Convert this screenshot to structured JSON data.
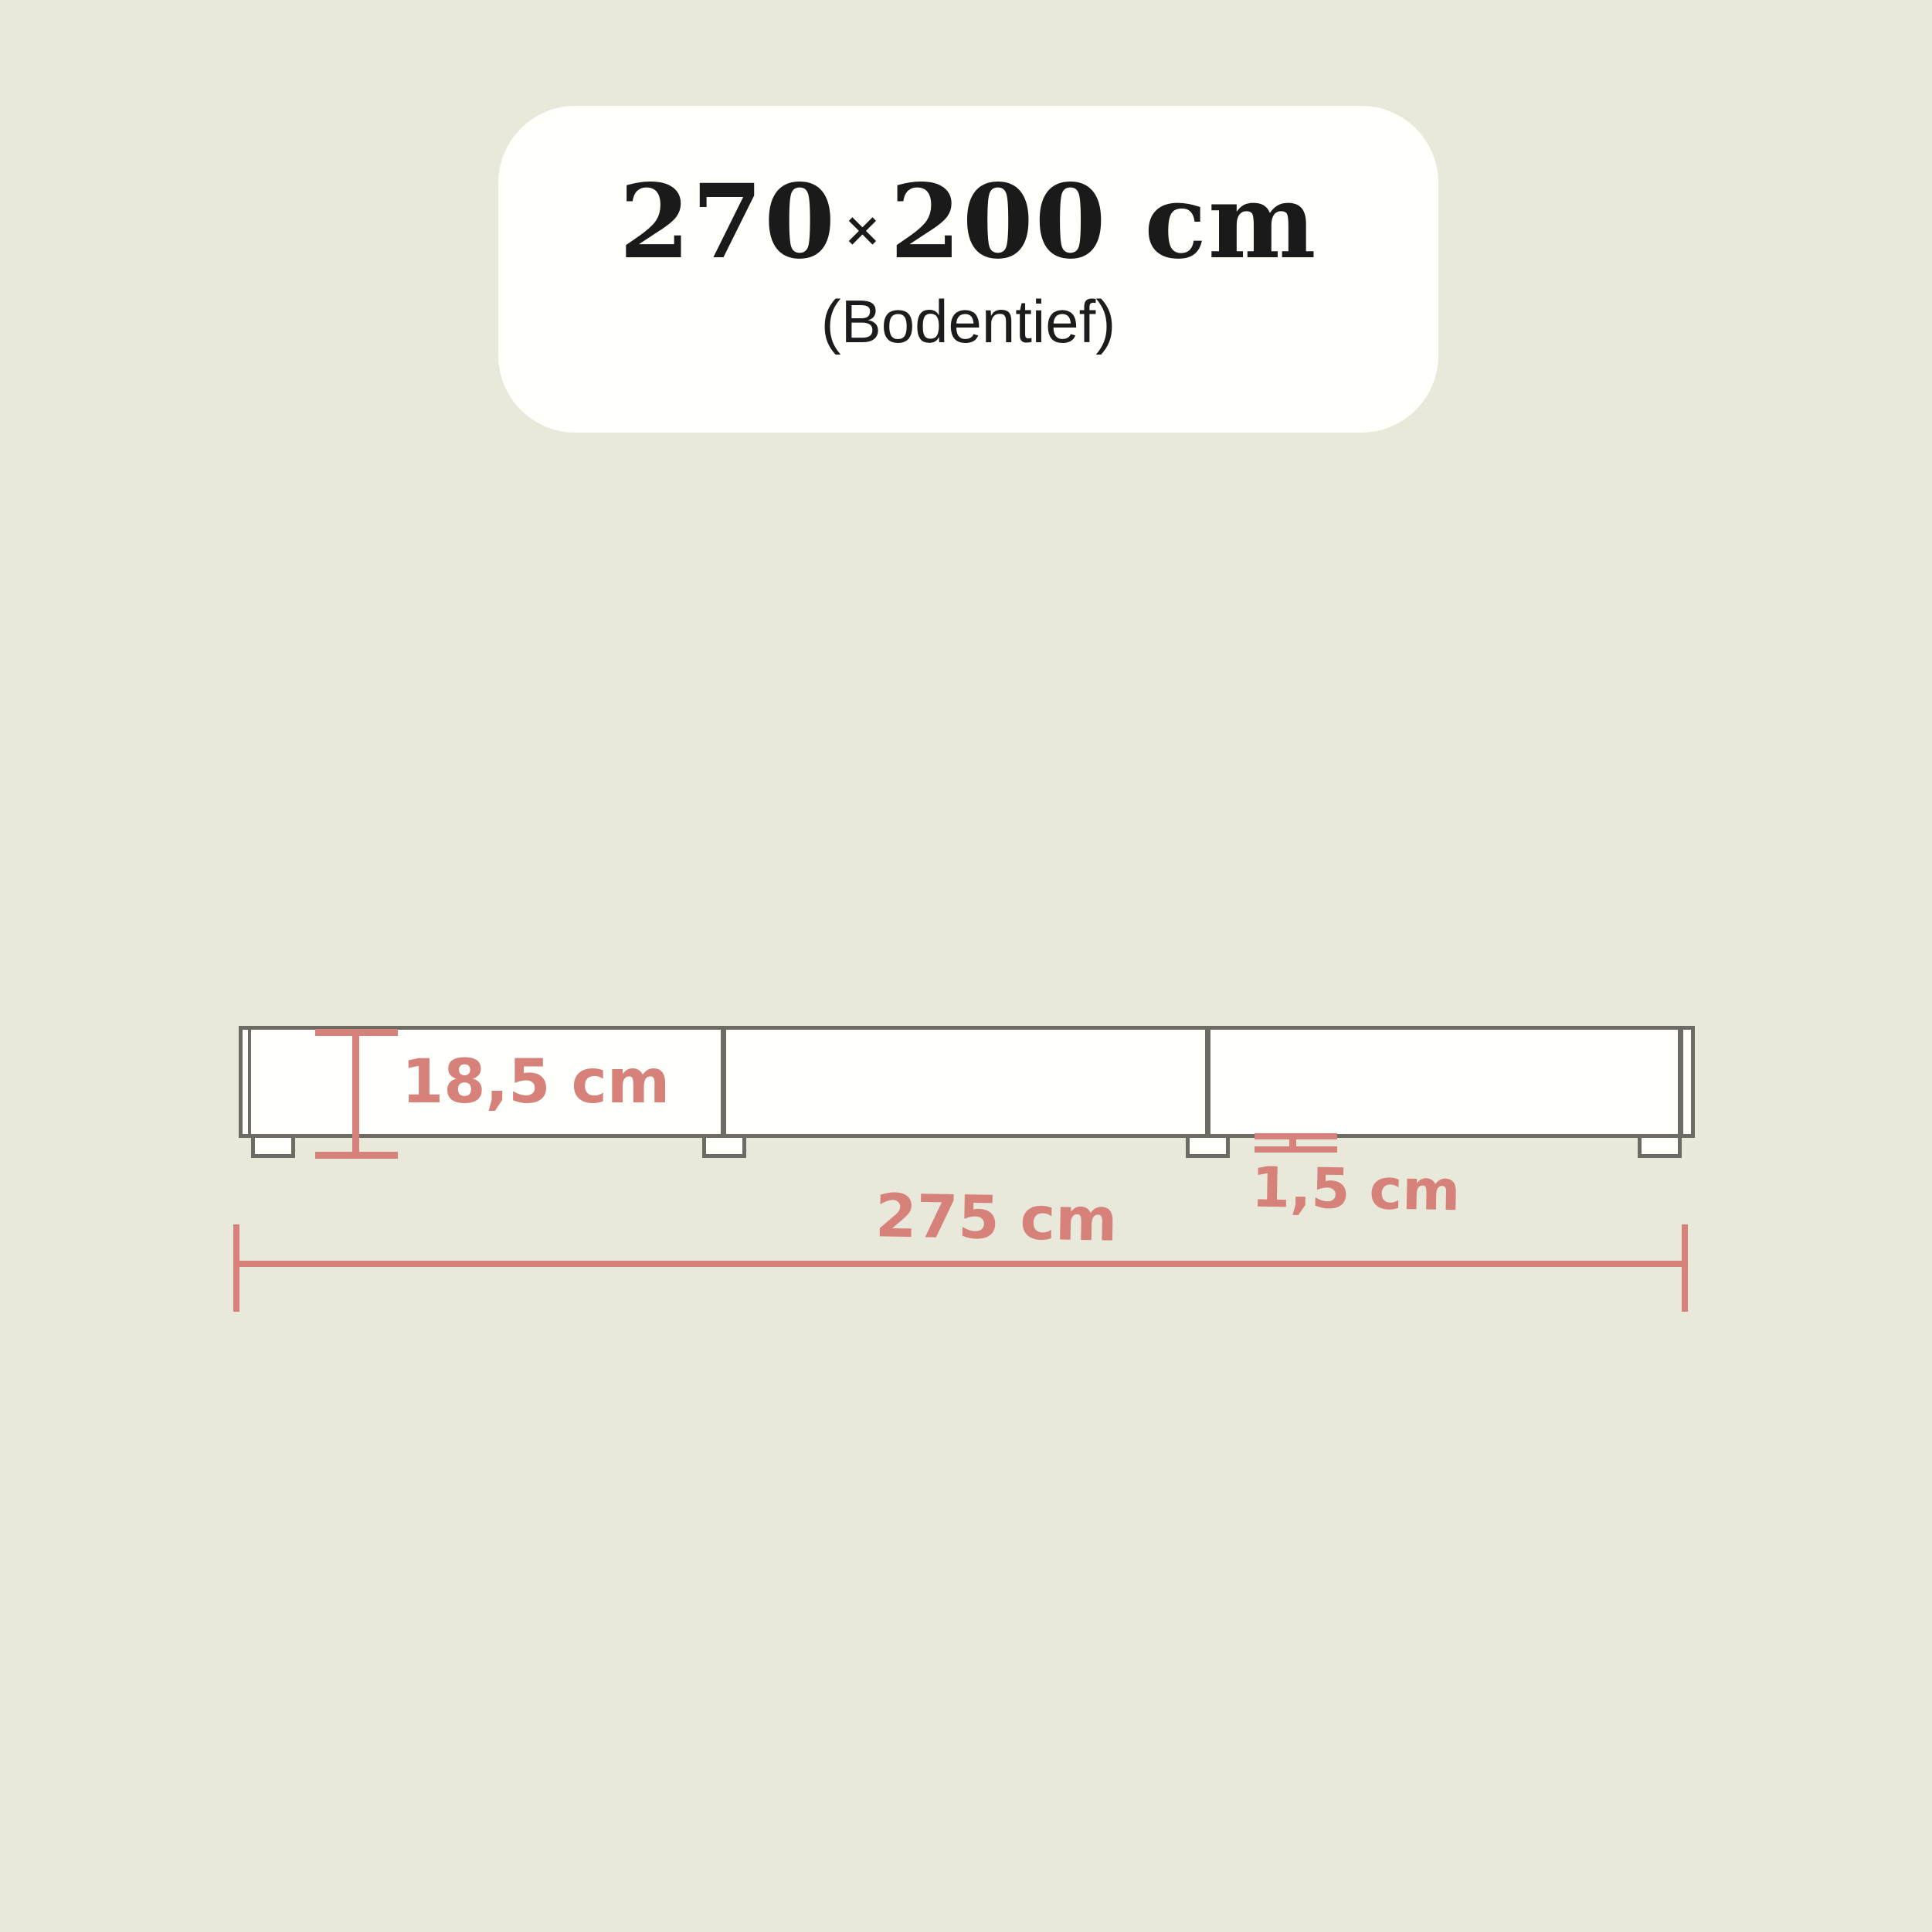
{
  "card": {
    "size_width": "270",
    "times_sign": "×",
    "size_rest": "200 cm",
    "subtitle": "(Bodentief)"
  },
  "diagram": {
    "height_label": "18,5 cm",
    "foot_height_label": "1,5 cm",
    "total_width_label": "275 cm"
  },
  "colors": {
    "background": "#e9e9db",
    "card": "#fffffc",
    "ink": "#1a1a1a",
    "line_gray": "#6e6a64",
    "accent_salmon": "#d6827a"
  }
}
